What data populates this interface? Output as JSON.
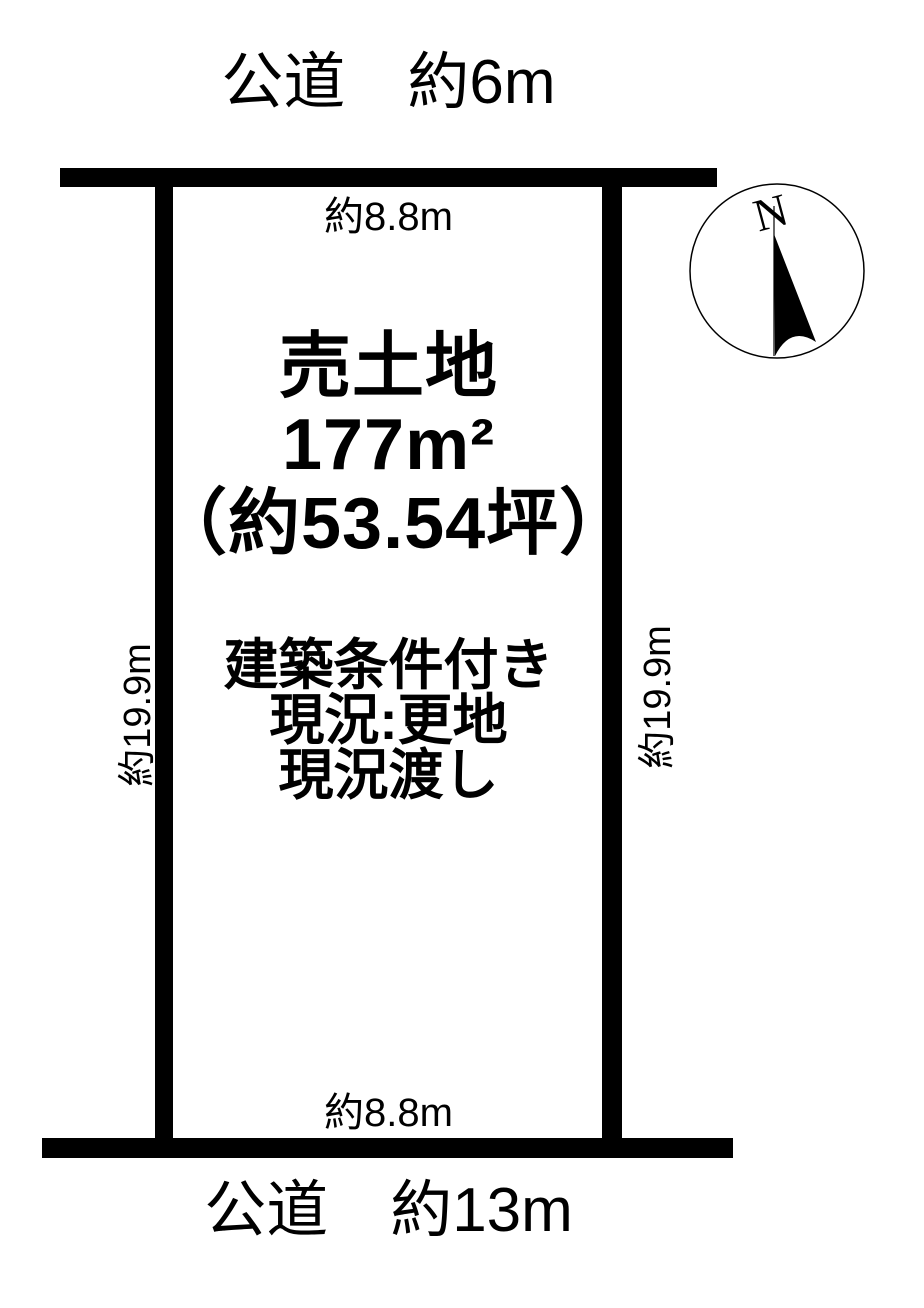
{
  "diagram": {
    "roads": {
      "top_label": "公道　約6m",
      "bottom_label": "公道　約13m"
    },
    "plot": {
      "type_label": "売土地",
      "area_sqm": "177m²",
      "area_tsubo": "（約53.54坪）",
      "notes": [
        "建築条件付き",
        "現況:更地",
        "現況渡し"
      ]
    },
    "dimensions": {
      "top": "約8.8m",
      "bottom": "約8.8m",
      "left": "約19.9m",
      "right": "約19.9m"
    },
    "compass": {
      "north_label": "N"
    },
    "colors": {
      "ink": "#000000",
      "background": "#ffffff"
    }
  }
}
